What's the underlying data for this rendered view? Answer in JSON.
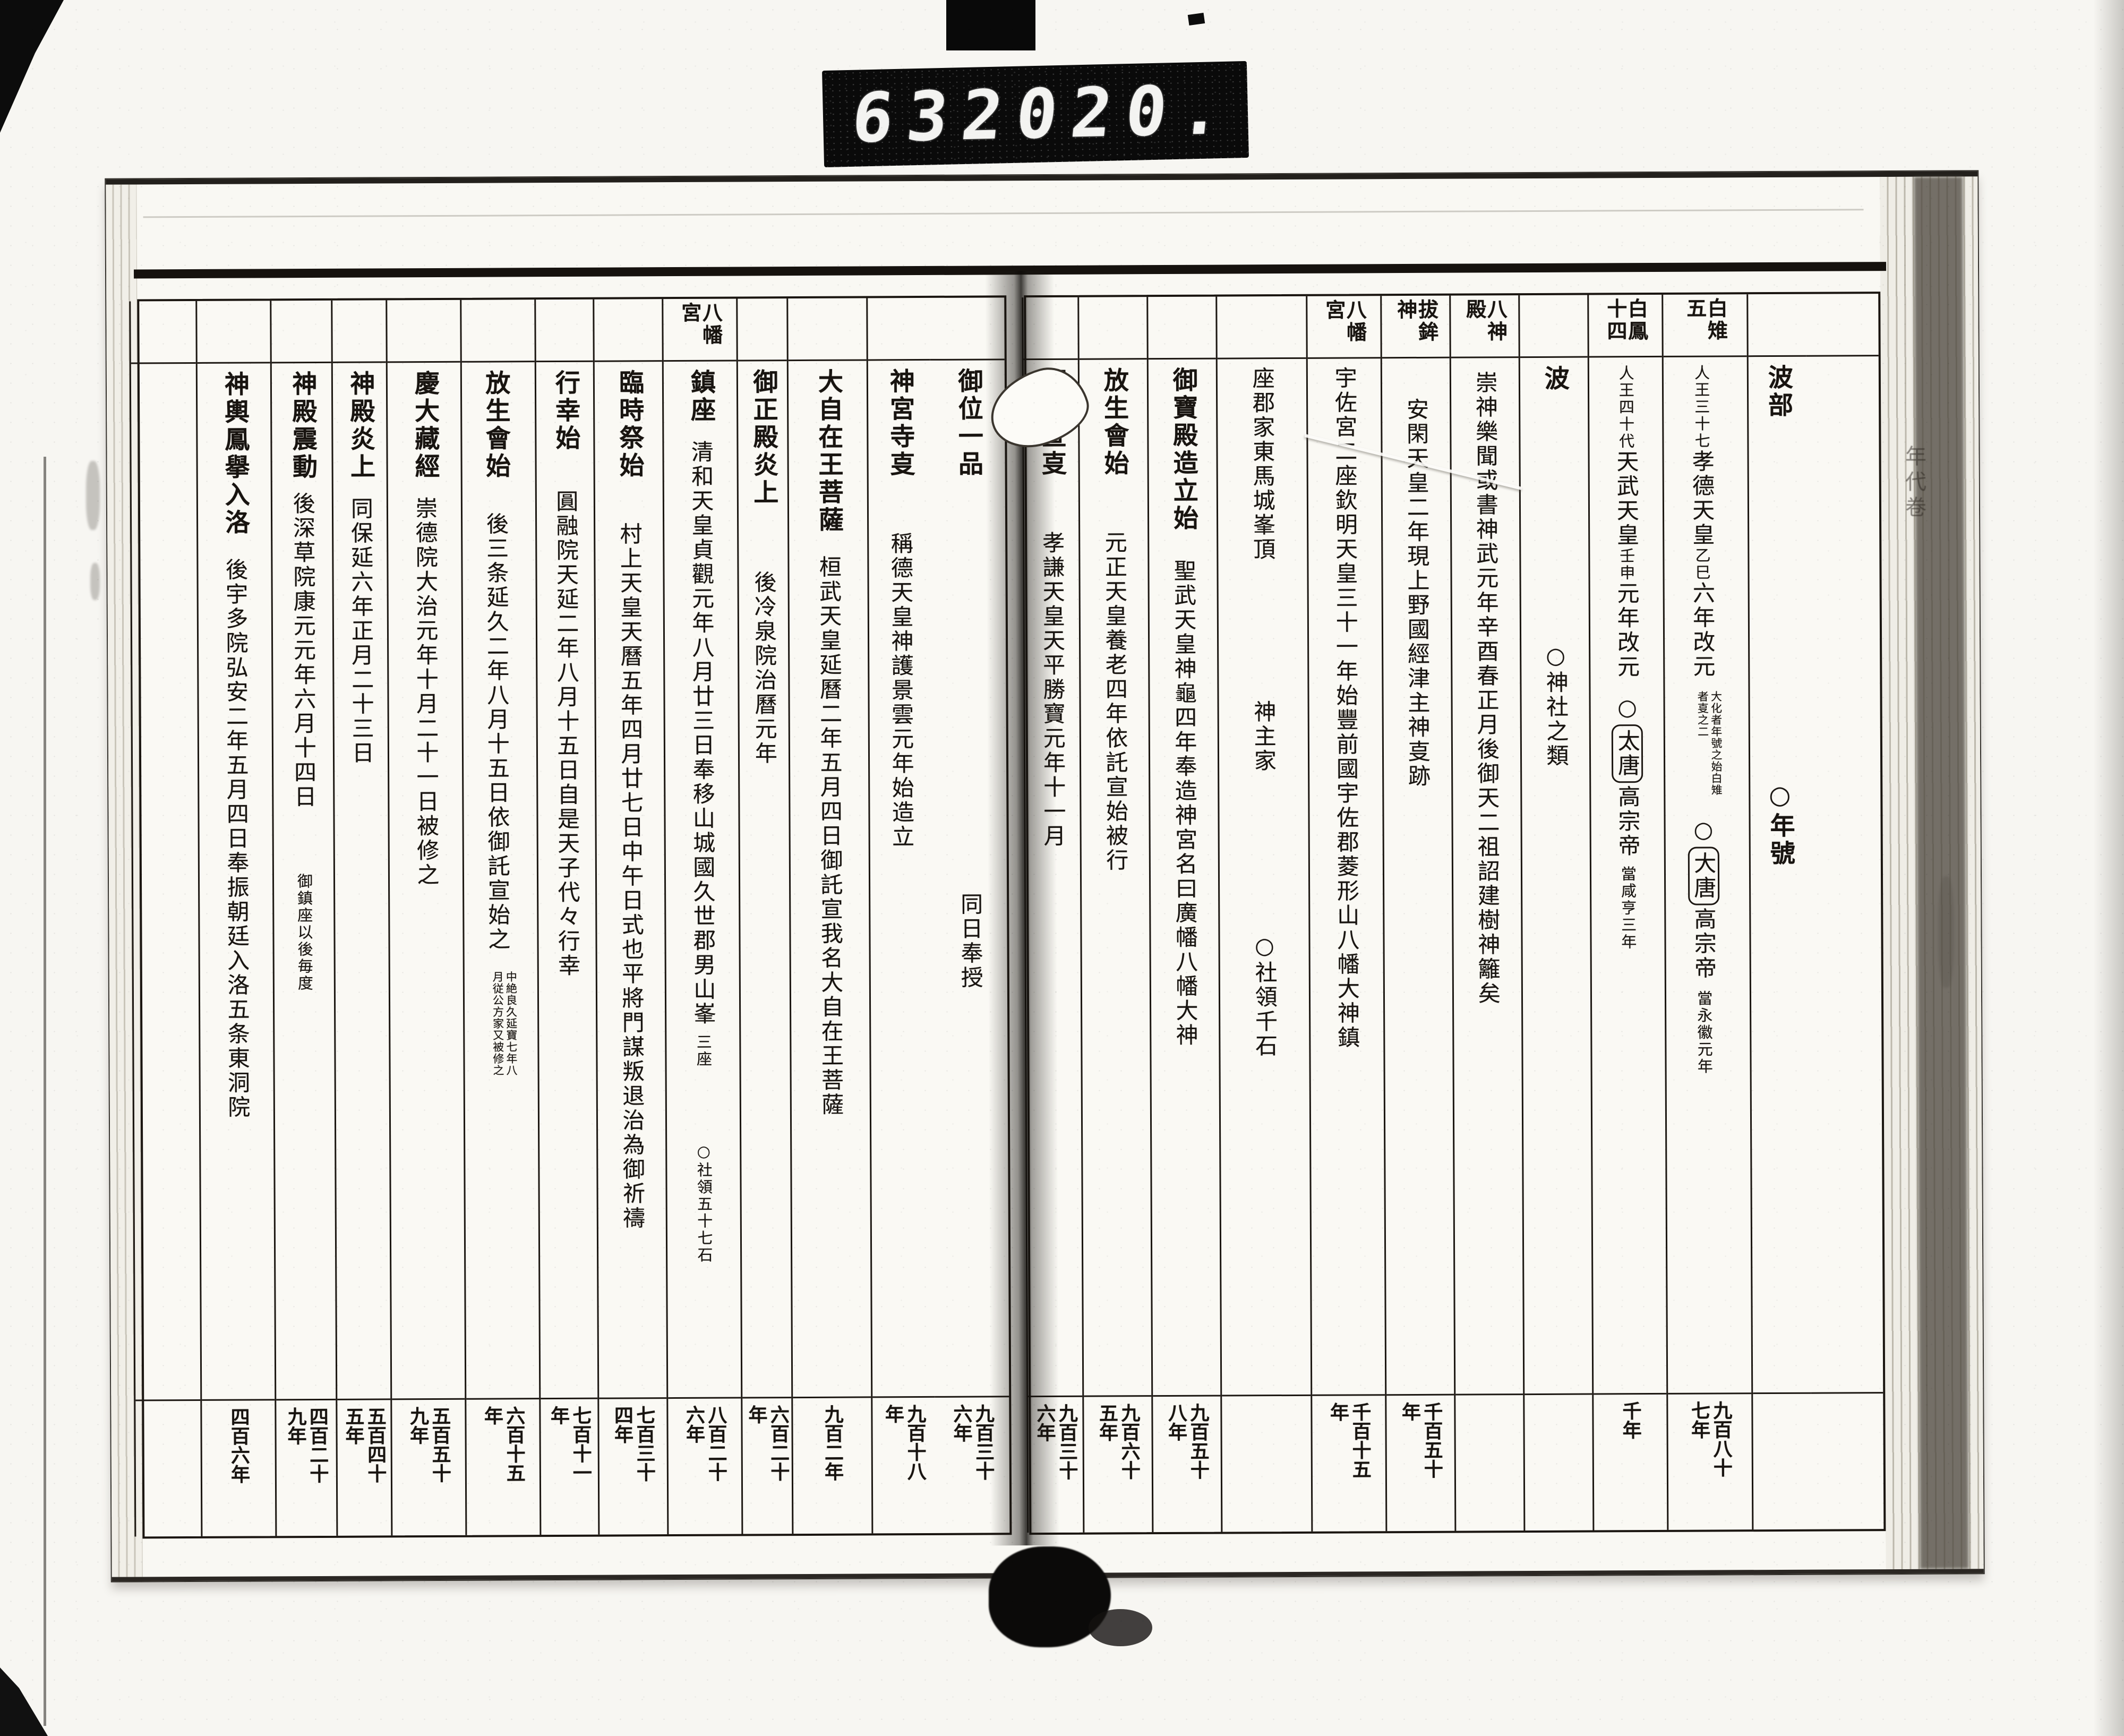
{
  "counter": {
    "left_digits": "632",
    "right_digits": "020."
  },
  "film": {
    "right_margin_label": "年代卷"
  },
  "pages": {
    "right": {
      "columns": [
        {
          "id": "blank-right",
          "w": 136,
          "header": "",
          "segs": [],
          "year": ""
        },
        {
          "id": "habe-nengo",
          "w": 112,
          "header": "",
          "segs": [
            {
              "t": "波部",
              "s": "t"
            },
            {
              "t": "○年號",
              "s": "t",
              "gap": 680
            }
          ],
          "year": ""
        },
        {
          "id": "hakuchi",
          "w": 160,
          "header": "白雉五",
          "segs": [
            {
              "t": "人王三十七",
              "s": "s"
            },
            {
              "t": "孝德天皇",
              "s": "n"
            },
            {
              "t": "乙巳",
              "s": "s"
            },
            {
              "t": "六年改元",
              "s": "n"
            },
            {
              "t": "大化者年號之始白雉者㕝之二",
              "s": "note",
              "gap": 22
            },
            {
              "t": "○",
              "s": "n",
              "gap": 22
            },
            {
              "t": "大唐",
              "s": "n",
              "box": true
            },
            {
              "t": "高宗帝",
              "s": "n"
            },
            {
              "t": "當永徽元年",
              "s": "s",
              "gap": 18
            }
          ],
          "year": "九百八十七年"
        },
        {
          "id": "hakuho",
          "w": 140,
          "header": "白鳳十四",
          "segs": [
            {
              "t": "人王四十代",
              "s": "s"
            },
            {
              "t": "天武天皇",
              "s": "n"
            },
            {
              "t": "壬申",
              "s": "s"
            },
            {
              "t": "元年改元",
              "s": "n"
            },
            {
              "t": "○",
              "s": "n",
              "gap": 28
            },
            {
              "t": "太唐",
              "s": "n",
              "box": true
            },
            {
              "t": "高宗帝",
              "s": "n"
            },
            {
              "t": "當咸亨三年",
              "s": "s",
              "gap": 14
            }
          ],
          "year": "千年"
        },
        {
          "id": "ha-jinja",
          "w": 130,
          "header": "",
          "segs": [
            {
              "t": "波",
              "s": "t"
            },
            {
              "t": "○神社之類",
              "s": "n",
              "gap": 470
            }
          ],
          "year": ""
        },
        {
          "id": "hasshinden",
          "w": 130,
          "header": "八神殿",
          "segs": [
            {
              "t": "崇神樂聞或書神武元年辛酉春正月後御天二祖詔建樹神籬矣",
              "s": "n",
              "gap": 10
            }
          ],
          "year": ""
        },
        {
          "id": "nukihoko",
          "w": 130,
          "header": "拔鉾神",
          "segs": [
            {
              "t": "安閑天皇二年現上野國經津主神㕝跡",
              "s": "n",
              "gap": 60
            }
          ],
          "year": "千百五十年"
        },
        {
          "id": "usa-gu",
          "w": 140,
          "header": "八幡宮",
          "segs": [
            {
              "t": "宇佐宮二座",
              "s": "n"
            },
            {
              "t": "欽明天皇三十一年始豐前國宇佐郡菱形山八幡大神鎮",
              "s": "n"
            }
          ],
          "year": "千百十五年"
        },
        {
          "id": "gunke",
          "w": 170,
          "header": "",
          "segs": [
            {
              "t": "座郡家東馬城峯頂",
              "s": "n"
            },
            {
              "t": "神主家",
              "s": "n",
              "gap": 260
            },
            {
              "t": "○社領千石",
              "s": "n",
              "gap": 300
            }
          ],
          "year": ""
        },
        {
          "id": "gohoden",
          "w": 130,
          "header": "",
          "segs": [
            {
              "t": "御寶殿造立始",
              "s": "t"
            },
            {
              "t": "聖武天皇神龜四年奉造神宮名曰廣幡八幡大神",
              "s": "n",
              "gap": 50
            }
          ],
          "year": "九百五十八年"
        },
        {
          "id": "hojoe-usa",
          "w": 130,
          "header": "",
          "segs": [
            {
              "t": "放生會始",
              "s": "t"
            },
            {
              "t": "元正天皇養老四年依託宣始被行",
              "s": "n",
              "gap": 100
            }
          ],
          "year": "九百六十五年"
        },
        {
          "id": "gotakusen",
          "w": 105,
          "header": "",
          "segs": [
            {
              "t": "御託宣㕝",
              "s": "t"
            },
            {
              "t": "孝謙天皇天平勝寶元年十一月",
              "s": "n",
              "gap": 100
            }
          ],
          "year": "九百三十六年"
        }
      ]
    },
    "left": {
      "columns": [
        {
          "id": "goi-ippon",
          "w": 140,
          "header": "",
          "segs": [
            {
              "t": "御位一品",
              "s": "t"
            },
            {
              "t": "同日奉授",
              "s": "n",
              "gap": 780
            }
          ],
          "year": "九百三十六年"
        },
        {
          "id": "jinguji",
          "w": 120,
          "header": "",
          "segs": [
            {
              "t": "神宮寺㕝",
              "s": "t"
            },
            {
              "t": "稱德天皇神護景雲元年始造立",
              "s": "n",
              "gap": 100
            }
          ],
          "year": "九百十八年"
        },
        {
          "id": "daijizaio",
          "w": 150,
          "header": "",
          "segs": [
            {
              "t": "大自在王菩薩",
              "s": "t"
            },
            {
              "t": "桓武天皇延曆二年五月四日御託宣我名大自在王菩薩",
              "s": "n",
              "gap": 40
            }
          ],
          "year": "九百二年"
        },
        {
          "id": "goshoden-enjo",
          "w": 95,
          "header": "",
          "segs": [
            {
              "t": "御正殿炎上",
              "s": "t"
            },
            {
              "t": "後冷泉院治曆元年",
              "s": "n",
              "gap": 120
            }
          ],
          "year": "六百二十年"
        },
        {
          "id": "chinza",
          "w": 140,
          "header": "八幡宮",
          "segs": [
            {
              "t": "鎮座",
              "s": "t"
            },
            {
              "t": "清和天皇貞觀元年八月廿三日奉移山城國久世郡男山峯",
              "s": "n",
              "gap": 30
            },
            {
              "t": "三座",
              "s": "s",
              "gap": 14
            },
            {
              "t": "○社領五十七石",
              "s": "s",
              "gap": 140
            }
          ],
          "year": "八百二十六年"
        },
        {
          "id": "rinjisai",
          "w": 130,
          "header": "",
          "segs": [
            {
              "t": "臨時祭始",
              "s": "t"
            },
            {
              "t": "村上天皇天曆五年四月廿七日中午日式也平將門謀叛退治為御祈禱",
              "s": "n",
              "gap": 80
            }
          ],
          "year": "七百三十四年"
        },
        {
          "id": "gyoko",
          "w": 110,
          "header": "",
          "segs": [
            {
              "t": "行幸始",
              "s": "t"
            },
            {
              "t": "圓融院天延二年八月十五日自是天子代々行幸",
              "s": "n",
              "gap": 70
            }
          ],
          "year": "七百十一年"
        },
        {
          "id": "hojoe-iwashimizu",
          "w": 140,
          "header": "",
          "segs": [
            {
              "t": "放生會始",
              "s": "t"
            },
            {
              "t": "後三条延久二年八月十五日依御託宣始之",
              "s": "n",
              "gap": 60
            },
            {
              "t": "中絶良久延寶七年八月従公方家又被修之",
              "s": "note",
              "gap": 36
            }
          ],
          "year": "六百十五年"
        },
        {
          "id": "daizokyo",
          "w": 140,
          "header": "",
          "segs": [
            {
              "t": "慶大藏經",
              "s": "t"
            },
            {
              "t": "崇德院大治元年十月二十一日被修之",
              "s": "n",
              "gap": 30
            }
          ],
          "year": "五百五十九年"
        },
        {
          "id": "shinden-enjo",
          "w": 103,
          "header": "",
          "segs": [
            {
              "t": "神殿炎上",
              "s": "t"
            },
            {
              "t": "同保延六年正月二十三日",
              "s": "n",
              "gap": 30
            }
          ],
          "year": "五百四十五年"
        },
        {
          "id": "shinden-shindo",
          "w": 115,
          "header": "",
          "segs": [
            {
              "t": "神殿震動",
              "s": "t"
            },
            {
              "t": "後深草院康元元年六月十四日",
              "s": "n",
              "gap": 20
            },
            {
              "t": "御鎮座以後毎度",
              "s": "s",
              "gap": 120
            }
          ],
          "year": "四百二十九年"
        },
        {
          "id": "mikoshi-juraku",
          "w": 140,
          "header": "",
          "segs": [
            {
              "t": "神輿鳳擧入洛",
              "s": "t"
            },
            {
              "t": "後宇多院弘安二年五月四日奉振朝廷入洛五条東洞院",
              "s": "n",
              "gap": 40
            }
          ],
          "year": "四百六年"
        },
        {
          "id": "blank-left",
          "w": 125,
          "header": "",
          "segs": [],
          "year": ""
        }
      ]
    }
  }
}
